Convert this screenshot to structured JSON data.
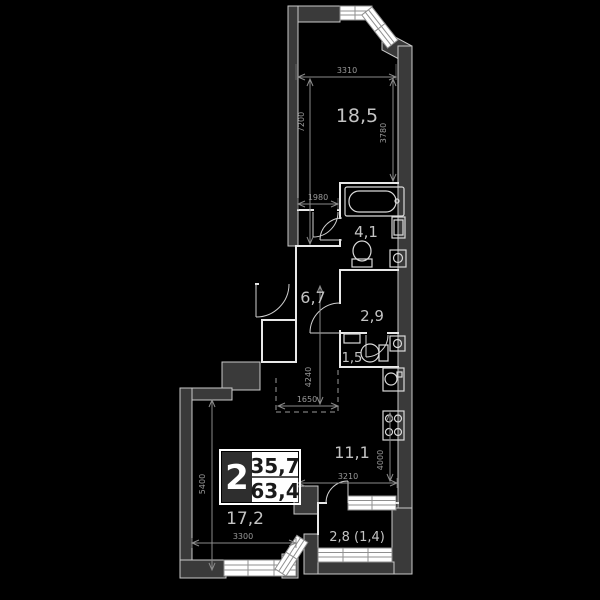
{
  "badge": {
    "rooms_count": "2",
    "area_living": "35,7",
    "area_total": "63,4"
  },
  "rooms": {
    "bedroom": "18,5",
    "bathroom": "4,1",
    "hallway": "6,7",
    "closet": "2,9",
    "wc": "1,5",
    "kitchen": "11,1",
    "living_room": "17,2",
    "balcony": "2,8 (1,4)"
  },
  "dimensions": {
    "bedroom_width": "3310",
    "bedroom_height": "7200",
    "bedroom_height_right": "3780",
    "hall_door_width": "1980",
    "hall_depth": "4240",
    "niche_width": "1650",
    "kitchen_width": "3210",
    "kitchen_depth": "4000",
    "living_height": "5400",
    "living_width": "3300"
  },
  "colors": {
    "background": "#000000",
    "wall": "#3a3a3a",
    "partition": "#e8e8e8",
    "window": "#ffffff",
    "dim_text": "#9a9a9a",
    "room_label": "#c4c4c4"
  }
}
